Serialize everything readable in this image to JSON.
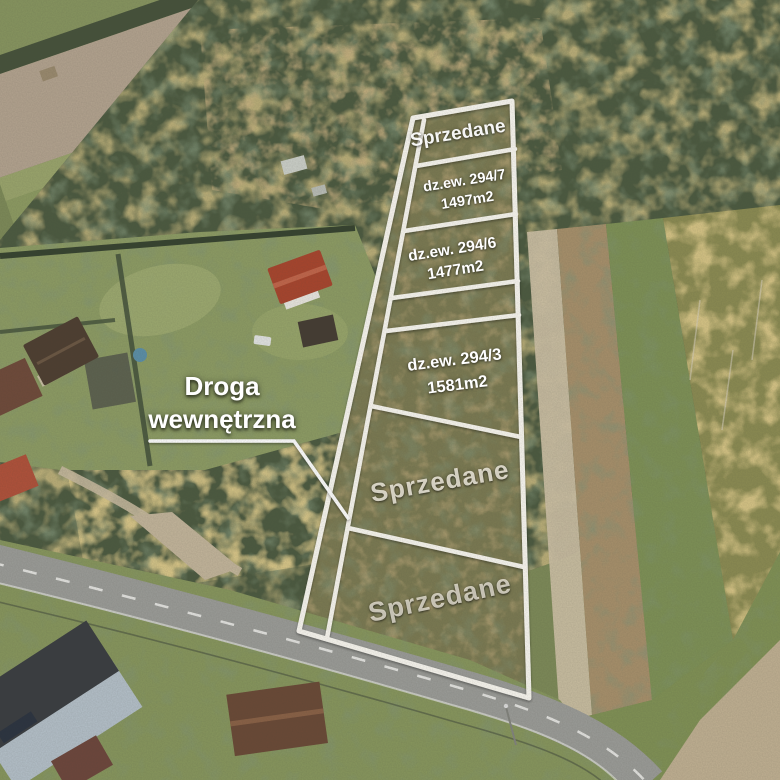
{
  "annotations": {
    "internal_road_label": {
      "line1": "Droga",
      "line2": "wewnętrzna"
    },
    "plots": [
      {
        "id": "plot-sold-top",
        "label": "Sprzedane"
      },
      {
        "id": "plot-294-7",
        "parcel": "dz.ew. 294/7",
        "area": "1497m2"
      },
      {
        "id": "plot-294-6",
        "parcel": "dz.ew. 294/6",
        "area": "1477m2"
      },
      {
        "id": "plot-294-3",
        "parcel": "dz.ew. 294/3",
        "area": "1581m2"
      },
      {
        "id": "plot-sold-middle",
        "label": "Sprzedane"
      },
      {
        "id": "plot-sold-bottom",
        "label": "Sprzedane"
      }
    ],
    "colors": {
      "boundary_lines": "#faf8f1",
      "label_text": "#ffffff",
      "sold_label_text": "#f7f2e4"
    }
  }
}
